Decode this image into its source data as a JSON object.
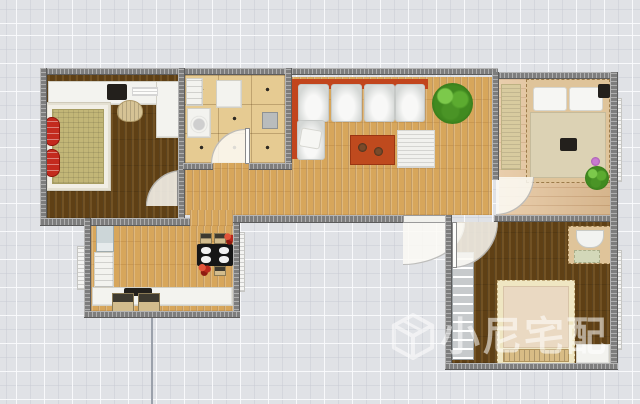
{
  "watermark": {
    "brand_text": "小尼宅配",
    "logo": "cube-3d-icon",
    "color": "rgba(255,255,255,0.55)"
  },
  "palette": {
    "background": "#e0e2e6",
    "grid_line": "#fafbfd",
    "wall": "#7d7d7d",
    "floor_dark_wood": "#5f4015",
    "floor_oak": "#d7a65b",
    "floor_light_plank": "#e3c095",
    "kitchen_tile": "#e6cb92",
    "sofa_orange": "#c2451d",
    "accent_red": "#c32a1e",
    "plant_green": "#418a20",
    "door_swing": "rgba(252,250,244,0.85)"
  },
  "rooms": [
    {
      "name": "bedroom-top-left",
      "floor": "dark-wood"
    },
    {
      "name": "kitchen",
      "floor": "beige-tile"
    },
    {
      "name": "living-room-hall",
      "floor": "oak-plank"
    },
    {
      "name": "bedroom-top-right",
      "floor": "light-plank"
    },
    {
      "name": "bedroom-bottom-right",
      "floor": "dark-wood"
    },
    {
      "name": "dining-room",
      "floor": "oak-plank"
    }
  ],
  "layers": [
    {
      "n": "bedroom1-floor",
      "c": "floor-dark",
      "x": 47,
      "y": 75,
      "w": 131,
      "h": 143
    },
    {
      "n": "kitchen-floor",
      "c": "floor-tile",
      "x": 185,
      "y": 75,
      "w": 100,
      "h": 88
    },
    {
      "n": "living-floor",
      "c": "floor-oak",
      "x": 292,
      "y": 77,
      "w": 200,
      "h": 138
    },
    {
      "n": "hall-floor",
      "c": "floor-oak",
      "x": 185,
      "y": 163,
      "w": 107,
      "h": 52
    },
    {
      "n": "dining-hall-connector-floor",
      "c": "floor-oak",
      "x": 190,
      "y": 210,
      "w": 43,
      "h": 16
    },
    {
      "n": "dining-floor",
      "c": "floor-oak",
      "x": 91,
      "y": 226,
      "w": 142,
      "h": 85
    },
    {
      "n": "bedroom3-floor",
      "c": "floor-plank-h",
      "x": 499,
      "y": 79,
      "w": 111,
      "h": 136
    },
    {
      "n": "bedroom2-floor",
      "c": "floor-dark",
      "x": 452,
      "y": 222,
      "w": 158,
      "h": 141
    },
    {
      "n": "bedroom1-desk",
      "c": "white-furn",
      "x": 48,
      "y": 81,
      "w": 110,
      "h": 24
    },
    {
      "n": "bedroom1-desk-return",
      "c": "white-furn",
      "x": 156,
      "y": 81,
      "w": 25,
      "h": 57
    },
    {
      "n": "desktop-computer",
      "c": "dark-item",
      "x": 107,
      "y": 84,
      "w": 20,
      "h": 16
    },
    {
      "n": "desk-paper",
      "c": "paper",
      "x": 132,
      "y": 87,
      "w": 26,
      "h": 9
    },
    {
      "n": "desk-chair",
      "c": "chair-round",
      "x": 117,
      "y": 100,
      "w": 26,
      "h": 22
    },
    {
      "n": "bedroom1-bed-frame",
      "c": "bedframe-white",
      "x": 46,
      "y": 103,
      "w": 64,
      "h": 87
    },
    {
      "n": "bedroom1-bed-mattress",
      "c": "mattress-khaki",
      "x": 52,
      "y": 109,
      "w": 52,
      "h": 75
    },
    {
      "n": "red-armchair-upper",
      "c": "red-item",
      "x": 46,
      "y": 117,
      "w": 14,
      "h": 29
    },
    {
      "n": "red-armchair-lower",
      "c": "red-item",
      "x": 46,
      "y": 149,
      "w": 14,
      "h": 28
    },
    {
      "n": "kitchen-sink",
      "c": "white-furn appliance",
      "x": 186,
      "y": 78,
      "w": 17,
      "h": 28
    },
    {
      "n": "kitchen-washer",
      "c": "white-furn appliance-drum",
      "x": 187,
      "y": 108,
      "w": 24,
      "h": 30
    },
    {
      "n": "kitchen-fridge",
      "c": "white-furn",
      "x": 216,
      "y": 80,
      "w": 26,
      "h": 28
    },
    {
      "n": "kitchen-small-appliance",
      "c": "grey-item",
      "x": 262,
      "y": 112,
      "w": 16,
      "h": 17
    },
    {
      "n": "sofa-back-horizontal",
      "c": "orange-item",
      "x": 292,
      "y": 79,
      "w": 136,
      "h": 10
    },
    {
      "n": "sofa-back-vertical",
      "c": "orange-item",
      "x": 292,
      "y": 79,
      "w": 10,
      "h": 80
    },
    {
      "n": "sofa-seat-1",
      "c": "sofa-seat",
      "x": 298,
      "y": 84,
      "w": 31,
      "h": 38
    },
    {
      "n": "sofa-seat-2",
      "c": "sofa-seat",
      "x": 331,
      "y": 84,
      "w": 31,
      "h": 38
    },
    {
      "n": "sofa-seat-3",
      "c": "sofa-seat",
      "x": 364,
      "y": 84,
      "w": 31,
      "h": 38
    },
    {
      "n": "sofa-seat-4",
      "c": "sofa-seat",
      "x": 395,
      "y": 84,
      "w": 30,
      "h": 38
    },
    {
      "n": "sofa-chaise",
      "c": "sofa-seat",
      "x": 297,
      "y": 120,
      "w": 28,
      "h": 40
    },
    {
      "n": "sofa-pillow",
      "c": "pillow-tilt",
      "x": 300,
      "y": 129,
      "w": 21,
      "h": 19
    },
    {
      "n": "living-plant",
      "c": "plant",
      "x": 432,
      "y": 83,
      "w": 41,
      "h": 41
    },
    {
      "n": "coffee-table-rug",
      "c": "orange-rug",
      "x": 350,
      "y": 135,
      "w": 45,
      "h": 30
    },
    {
      "n": "rug-decor-a",
      "c": "decor-dot",
      "x": 358,
      "y": 143,
      "w": 9,
      "h": 9
    },
    {
      "n": "rug-decor-b",
      "c": "decor-dot",
      "x": 374,
      "y": 147,
      "w": 9,
      "h": 9
    },
    {
      "n": "living-floor-mat",
      "c": "ridged-white",
      "x": 397,
      "y": 130,
      "w": 38,
      "h": 38
    },
    {
      "n": "bedroom3-wardrobe",
      "c": "tan-texture",
      "x": 501,
      "y": 84,
      "w": 20,
      "h": 86
    },
    {
      "n": "bedroom3-bed-frame",
      "c": "bedframe-tan",
      "x": 526,
      "y": 79,
      "w": 84,
      "h": 104
    },
    {
      "n": "bedroom3-pillow-left",
      "c": "pillow",
      "x": 533,
      "y": 87,
      "w": 34,
      "h": 24
    },
    {
      "n": "bedroom3-pillow-right",
      "c": "pillow",
      "x": 569,
      "y": 87,
      "w": 34,
      "h": 24
    },
    {
      "n": "bedroom3-blanket",
      "c": "blanket",
      "x": 530,
      "y": 112,
      "w": 76,
      "h": 66
    },
    {
      "n": "bedroom3-item-on-bed",
      "c": "dark-item",
      "x": 560,
      "y": 138,
      "w": 17,
      "h": 13
    },
    {
      "n": "bedroom3-nightstand",
      "c": "dark-item",
      "x": 598,
      "y": 84,
      "w": 12,
      "h": 14
    },
    {
      "n": "bedroom3-plant",
      "c": "plant",
      "x": 585,
      "y": 166,
      "w": 24,
      "h": 24
    },
    {
      "n": "bedroom3-purple-flower",
      "c": "flower",
      "x": 591,
      "y": 157,
      "w": 9,
      "h": 9
    },
    {
      "n": "bedroom2-wardrobe",
      "c": "wardrobe-grey",
      "x": 452,
      "y": 252,
      "w": 22,
      "h": 108
    },
    {
      "n": "bedroom2-dresser",
      "c": "bedframe-tan",
      "x": 568,
      "y": 226,
      "w": 44,
      "h": 38
    },
    {
      "n": "dresser-bench",
      "c": "bench-white",
      "x": 576,
      "y": 230,
      "w": 28,
      "h": 18
    },
    {
      "n": "dresser-pad",
      "c": "pad-green",
      "x": 574,
      "y": 250,
      "w": 26,
      "h": 13
    },
    {
      "n": "bedroom2-bed-frame",
      "c": "bedframe-cream",
      "x": 497,
      "y": 280,
      "w": 78,
      "h": 84
    },
    {
      "n": "bedroom2-bed-mattress",
      "c": "mattress-cream",
      "x": 503,
      "y": 286,
      "w": 66,
      "h": 62
    },
    {
      "n": "bedroom2-bed-bench",
      "c": "slat-bench",
      "x": 503,
      "y": 349,
      "w": 66,
      "h": 13
    },
    {
      "n": "bedroom2-side-table",
      "c": "white-furn",
      "x": 576,
      "y": 344,
      "w": 34,
      "h": 20
    },
    {
      "n": "dining-fridge",
      "c": "fridge-blue",
      "x": 96,
      "y": 224,
      "w": 18,
      "h": 28
    },
    {
      "n": "dining-cabinet",
      "c": "white-furn appliance",
      "x": 94,
      "y": 252,
      "w": 20,
      "h": 36
    },
    {
      "n": "dining-counter",
      "c": "white-furn",
      "x": 92,
      "y": 287,
      "w": 141,
      "h": 19
    },
    {
      "n": "counter-cooktop",
      "c": "dark-item",
      "x": 124,
      "y": 288,
      "w": 28,
      "h": 8
    },
    {
      "n": "counter-stool-left",
      "c": "stool",
      "x": 112,
      "y": 293,
      "w": 22,
      "h": 19
    },
    {
      "n": "counter-stool-right",
      "c": "stool",
      "x": 138,
      "y": 293,
      "w": 22,
      "h": 19
    },
    {
      "n": "dining-table",
      "c": "black-table",
      "x": 197,
      "y": 244,
      "w": 36,
      "h": 22
    },
    {
      "n": "plate-top-left",
      "c": "plate",
      "x": 201,
      "y": 247,
      "w": 10,
      "h": 7
    },
    {
      "n": "plate-top-right",
      "c": "plate",
      "x": 219,
      "y": 247,
      "w": 10,
      "h": 7
    },
    {
      "n": "plate-bottom-left",
      "c": "plate",
      "x": 201,
      "y": 256,
      "w": 10,
      "h": 7
    },
    {
      "n": "plate-bottom-right",
      "c": "plate",
      "x": 219,
      "y": 256,
      "w": 10,
      "h": 7
    },
    {
      "n": "dining-chair-top-left",
      "c": "stool",
      "x": 200,
      "y": 233,
      "w": 12,
      "h": 11
    },
    {
      "n": "dining-chair-top-right",
      "c": "stool",
      "x": 214,
      "y": 233,
      "w": 12,
      "h": 11
    },
    {
      "n": "dining-chair-bottom",
      "c": "stool",
      "x": 214,
      "y": 266,
      "w": 12,
      "h": 10
    },
    {
      "n": "dining-flowers-red",
      "c": "red-flower",
      "x": 224,
      "y": 233,
      "w": 12,
      "h": 12
    },
    {
      "n": "dining-flowers-dark",
      "c": "red-flower",
      "x": 198,
      "y": 264,
      "w": 14,
      "h": 12
    },
    {
      "n": "radiator-dining-left",
      "c": "radiator-v",
      "x": 77,
      "y": 246,
      "w": 9,
      "h": 44
    },
    {
      "n": "radiator-dining-right",
      "c": "radiator-v",
      "x": 236,
      "y": 232,
      "w": 9,
      "h": 60
    },
    {
      "n": "radiator-bedroom3",
      "c": "radiator-v",
      "x": 613,
      "y": 98,
      "w": 9,
      "h": 84
    },
    {
      "n": "radiator-bedroom2",
      "c": "radiator-v",
      "x": 613,
      "y": 250,
      "w": 9,
      "h": 100
    },
    {
      "n": "door-arc-bedroom1",
      "c": "arc arc-tl",
      "x": 146,
      "y": 170,
      "w": 36,
      "h": 36
    },
    {
      "n": "door-leaf-bedroom1",
      "c": "door-leaf-v",
      "x": 177,
      "y": 170,
      "w": 5,
      "h": 36
    },
    {
      "n": "door-arc-kitchen",
      "c": "arc arc-tl",
      "x": 211,
      "y": 129,
      "w": 34,
      "h": 34
    },
    {
      "n": "door-leaf-kitchen",
      "c": "door-leaf-v",
      "x": 245,
      "y": 128,
      "w": 5,
      "h": 36
    },
    {
      "n": "door-arc-entry",
      "c": "arc arc-br",
      "x": 403,
      "y": 223,
      "w": 62,
      "h": 42
    },
    {
      "n": "door-arc-bedroom2",
      "c": "arc arc-br",
      "x": 452,
      "y": 222,
      "w": 46,
      "h": 46
    },
    {
      "n": "door-leaf-bedroom2",
      "c": "door-leaf-v",
      "x": 452,
      "y": 222,
      "w": 5,
      "h": 46
    },
    {
      "n": "door-arc-bedroom3",
      "c": "arc arc-br",
      "x": 496,
      "y": 177,
      "w": 38,
      "h": 38
    },
    {
      "n": "wall-top-main",
      "c": "wall wall-h",
      "x": 40,
      "y": 68,
      "w": 458,
      "h": 7
    },
    {
      "n": "wall-top-bedroom3",
      "c": "wall wall-h",
      "x": 492,
      "y": 72,
      "w": 126,
      "h": 7
    },
    {
      "n": "wall-bedroom1-left",
      "c": "wall wall-v",
      "x": 40,
      "y": 68,
      "w": 7,
      "h": 157
    },
    {
      "n": "wall-bedroom1-kitchen",
      "c": "wall wall-v",
      "x": 178,
      "y": 68,
      "w": 7,
      "h": 150
    },
    {
      "n": "wall-kitchen-living",
      "c": "wall wall-v",
      "x": 285,
      "y": 68,
      "w": 7,
      "h": 102
    },
    {
      "n": "wall-kitchen-bottom-left",
      "c": "wall wall-h",
      "x": 183,
      "y": 163,
      "w": 30,
      "h": 7
    },
    {
      "n": "wall-kitchen-bottom-right",
      "c": "wall wall-h",
      "x": 249,
      "y": 163,
      "w": 43,
      "h": 7
    },
    {
      "n": "wall-bedroom1-bottom",
      "c": "wall wall-h",
      "x": 40,
      "y": 218,
      "w": 150,
      "h": 8
    },
    {
      "n": "wall-hall-bottom",
      "c": "wall wall-h",
      "x": 233,
      "y": 215,
      "w": 170,
      "h": 8
    },
    {
      "n": "entry-door-leaf",
      "c": "door-leaf-h",
      "x": 403,
      "y": 215,
      "w": 46,
      "h": 8
    },
    {
      "n": "wall-bedroom2-top",
      "c": "wall wall-h",
      "x": 494,
      "y": 215,
      "w": 124,
      "h": 7
    },
    {
      "n": "wall-living-bedroom3",
      "c": "wall wall-v",
      "x": 492,
      "y": 72,
      "w": 7,
      "h": 108
    },
    {
      "n": "wall-bedroom3-right",
      "c": "wall wall-v",
      "x": 610,
      "y": 72,
      "w": 8,
      "h": 150
    },
    {
      "n": "wall-bedroom2-right",
      "c": "wall wall-v",
      "x": 610,
      "y": 215,
      "w": 8,
      "h": 155
    },
    {
      "n": "wall-bedroom2-left",
      "c": "wall wall-v",
      "x": 445,
      "y": 215,
      "w": 7,
      "h": 155
    },
    {
      "n": "wall-bedroom2-bottom",
      "c": "wall wall-h",
      "x": 445,
      "y": 363,
      "w": 173,
      "h": 7
    },
    {
      "n": "wall-dining-left",
      "c": "wall wall-v",
      "x": 84,
      "y": 218,
      "w": 7,
      "h": 100
    },
    {
      "n": "wall-dining-right",
      "c": "wall wall-v",
      "x": 233,
      "y": 223,
      "w": 7,
      "h": 95
    },
    {
      "n": "wall-dining-bottom",
      "c": "wall wall-h",
      "x": 84,
      "y": 311,
      "w": 156,
      "h": 7
    },
    {
      "n": "grid-guide-line",
      "c": "guide",
      "x": 151,
      "y": 318,
      "w": 2,
      "h": 86
    }
  ]
}
